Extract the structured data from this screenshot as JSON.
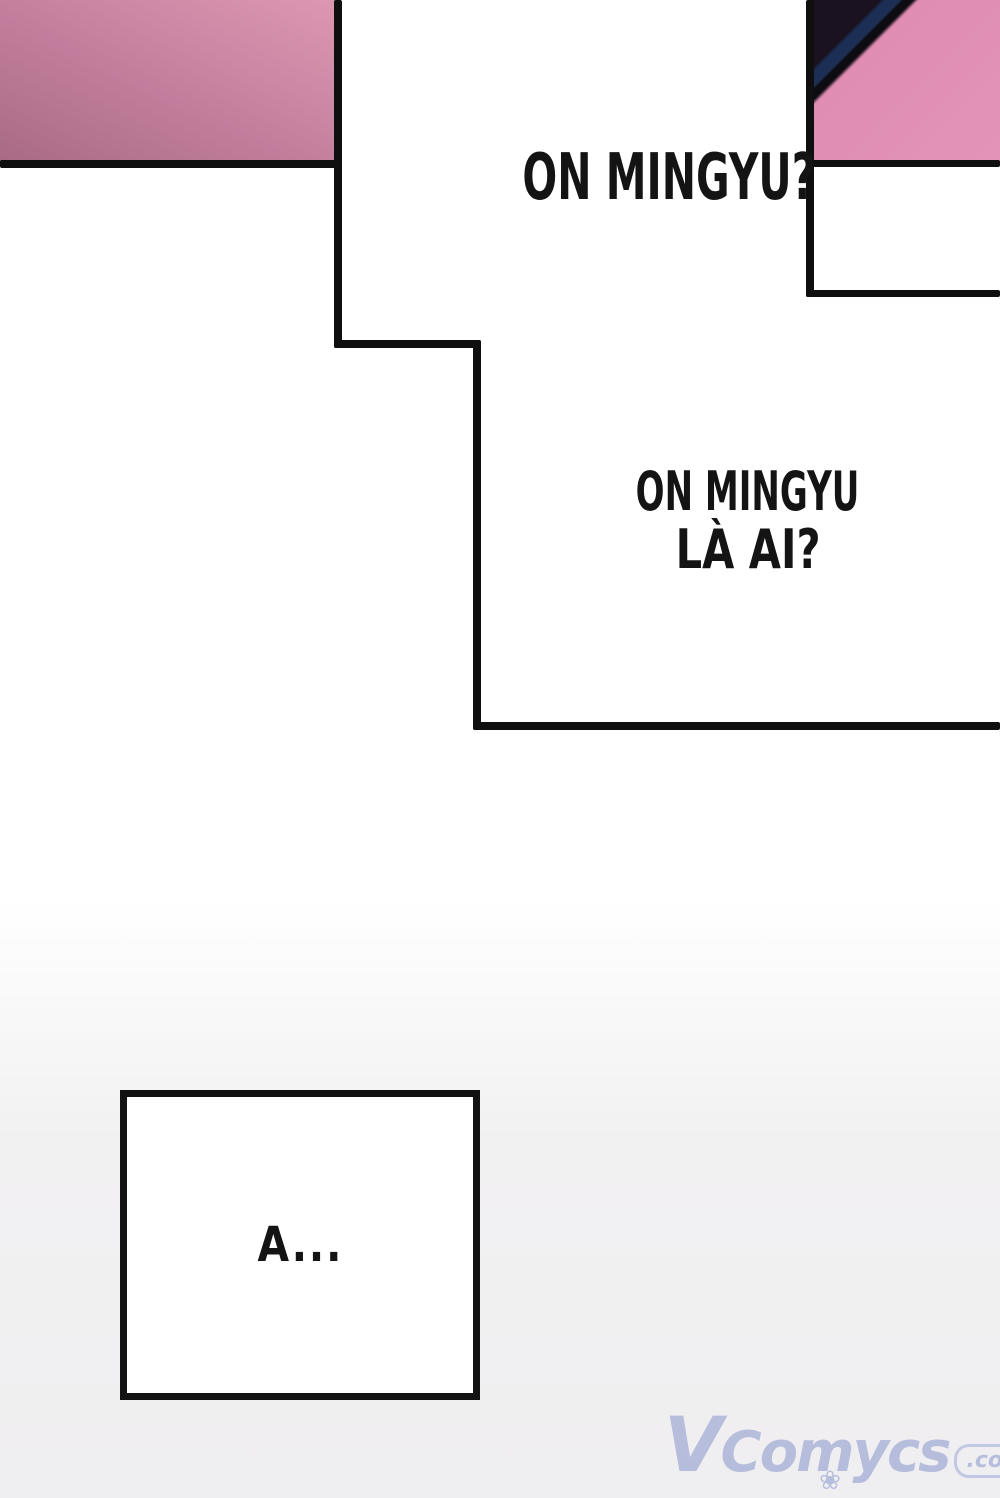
{
  "page": {
    "width": 1000,
    "height": 1498,
    "background_top": "#ffffff",
    "background_bottom": "#efeef0"
  },
  "artwork": {
    "border_color": "#0f0f0f",
    "left_panel": {
      "description": "pink gradient artwork fragment",
      "color_light": "#dd97b2",
      "color_dark": "#a96a85"
    },
    "right_panel": {
      "description": "pink artwork fragment with dark diagonal stripes in corner",
      "pink": "#df8db1",
      "stripe_dark": "#1a1220",
      "stripe_navy": "#1d2e55",
      "stripe_black": "#0c0c12"
    }
  },
  "speech": {
    "bubble1": {
      "text": "ON MINGYU?"
    },
    "bubble2": {
      "line1": "ON MINGYU",
      "line2": "LÀ AI?"
    },
    "bubble3": {
      "text": "A..."
    }
  },
  "watermark": {
    "brand": "VComycs",
    "suffix": ".com",
    "color": "#a9b2d8"
  },
  "icons": {
    "flower": "❀"
  }
}
